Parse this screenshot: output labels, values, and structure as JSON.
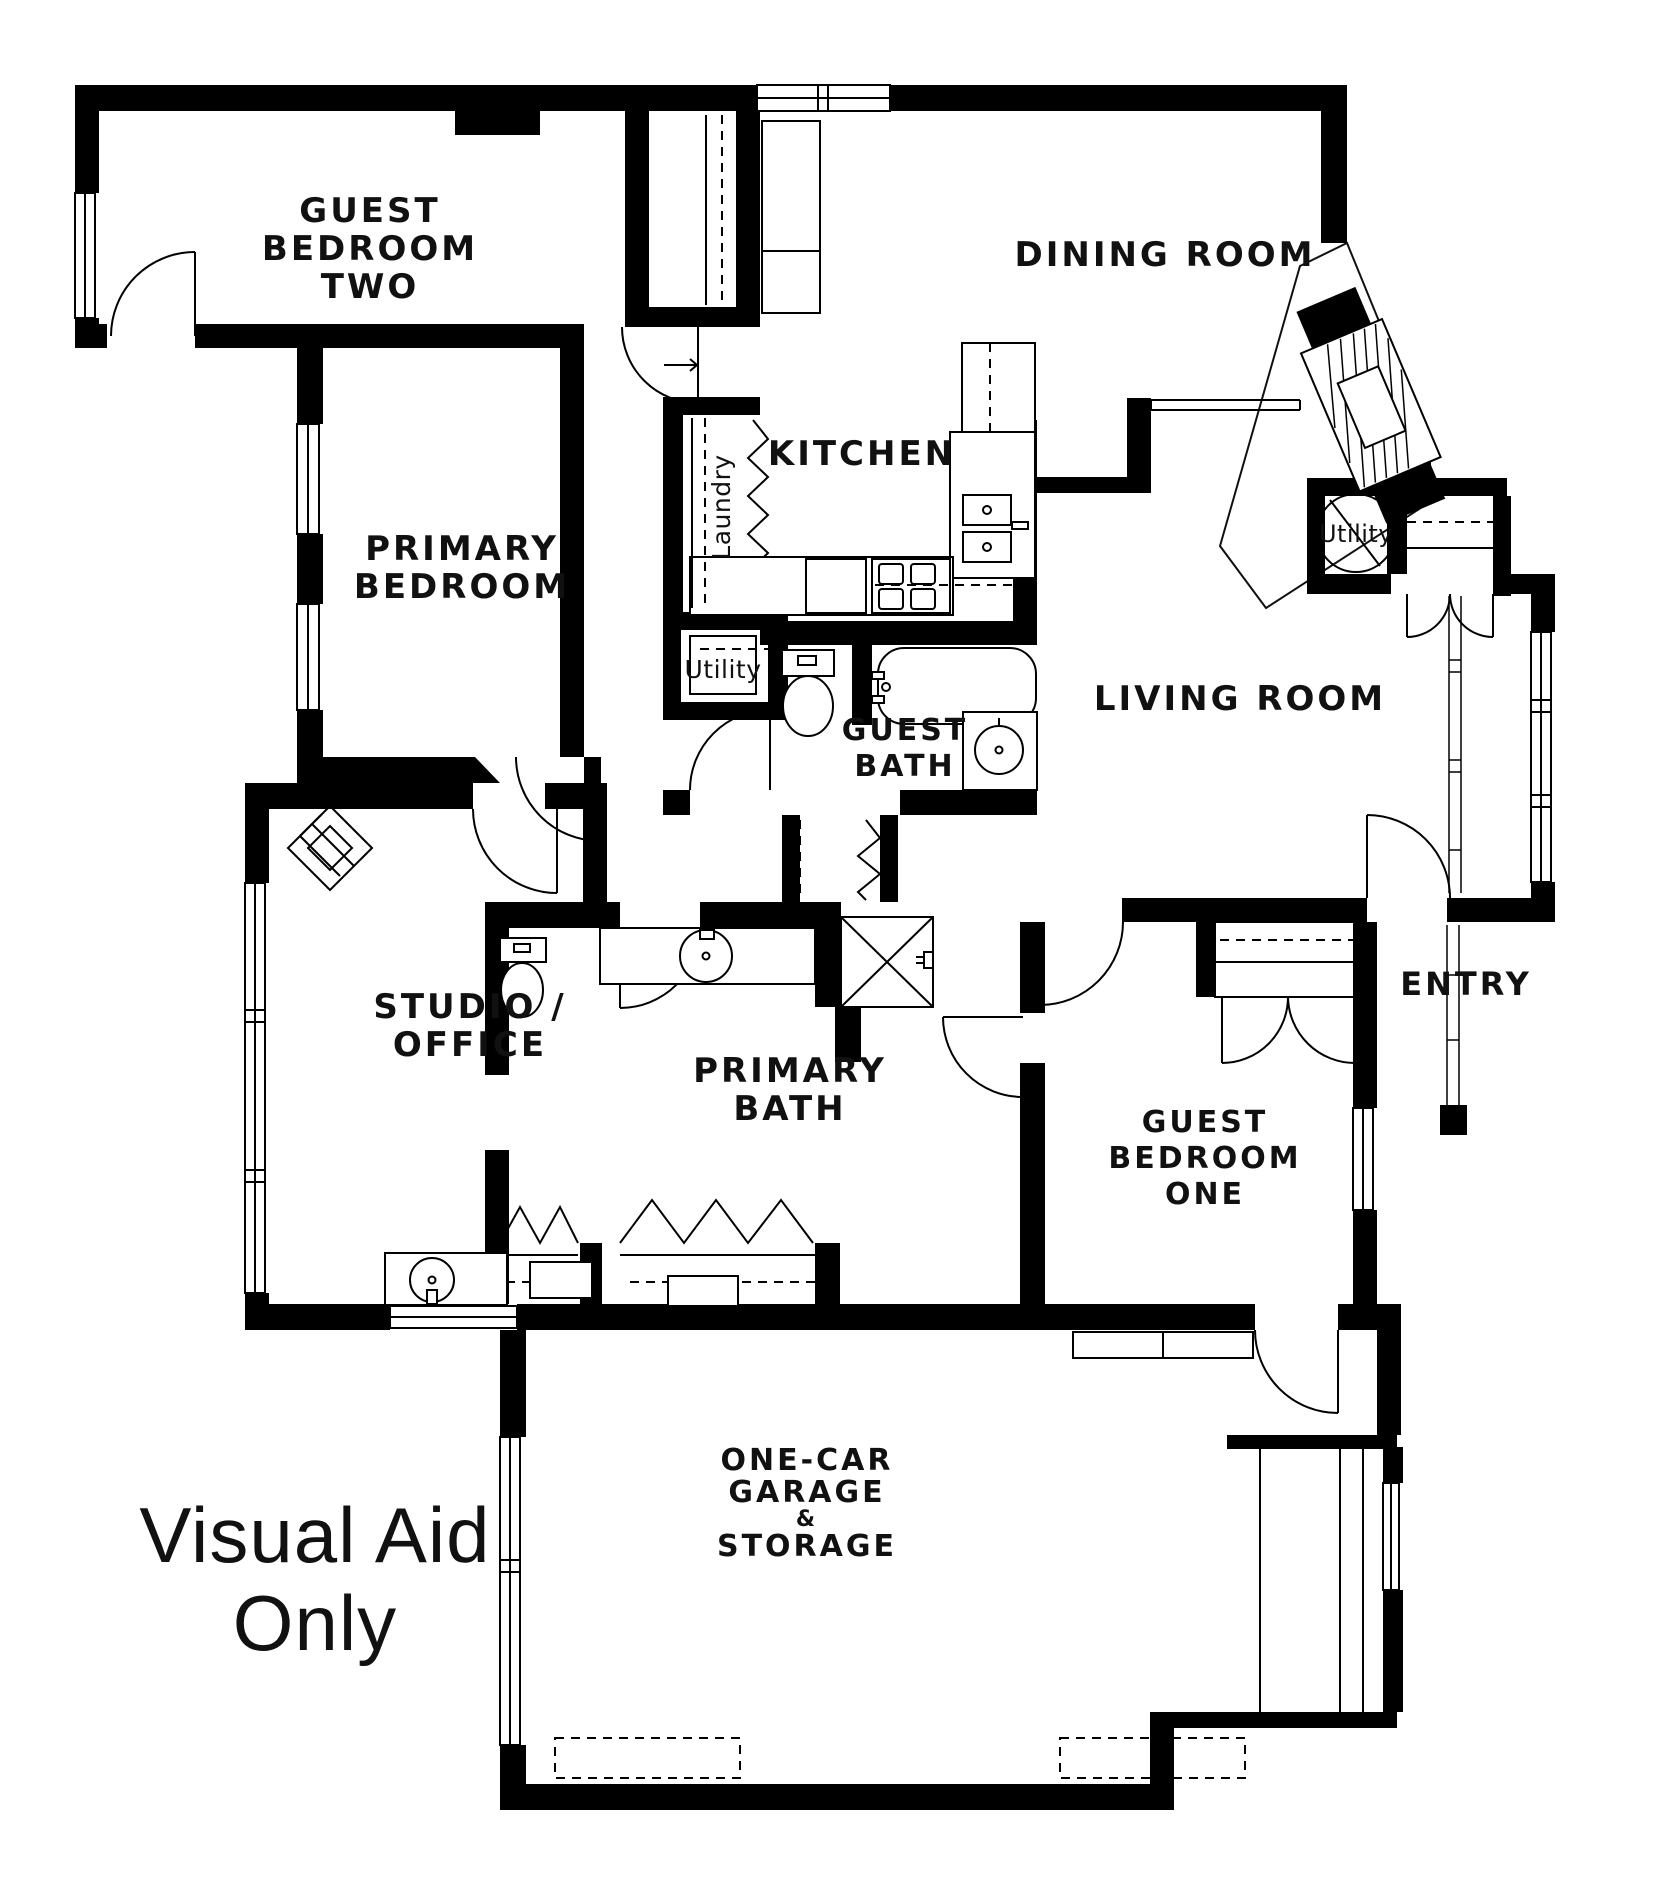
{
  "watermark": {
    "line1": "Visual Aid",
    "line2": "Only"
  },
  "rooms": {
    "guest_bedroom_two": {
      "line1": "GUEST",
      "line2": "BEDROOM",
      "line3": "TWO"
    },
    "dining_room": {
      "label": "DINING ROOM"
    },
    "kitchen": {
      "label": "KITCHEN"
    },
    "laundry": {
      "label": "Laundry"
    },
    "hall_utility": {
      "label": "Utility"
    },
    "water_heater_utility": {
      "label": "Utility"
    },
    "guest_bath": {
      "line1": "GUEST",
      "line2": "BATH"
    },
    "living_room": {
      "label": "LIVING ROOM"
    },
    "primary_bedroom": {
      "line1": "PRIMARY",
      "line2": "BEDROOM"
    },
    "studio_office": {
      "line1": "STUDIO /",
      "line2": "OFFICE"
    },
    "primary_bath": {
      "line1": "PRIMARY",
      "line2": "BATH"
    },
    "guest_bedroom_one": {
      "line1": "GUEST",
      "line2": "BEDROOM",
      "line3": "ONE"
    },
    "entry": {
      "label": "ENTRY"
    },
    "garage": {
      "line1": "ONE-CAR",
      "line2": "GARAGE",
      "line3": "&",
      "line4": "STORAGE"
    }
  },
  "colors": {
    "wall": "#000000",
    "background": "#ffffff",
    "line": "#111111"
  }
}
